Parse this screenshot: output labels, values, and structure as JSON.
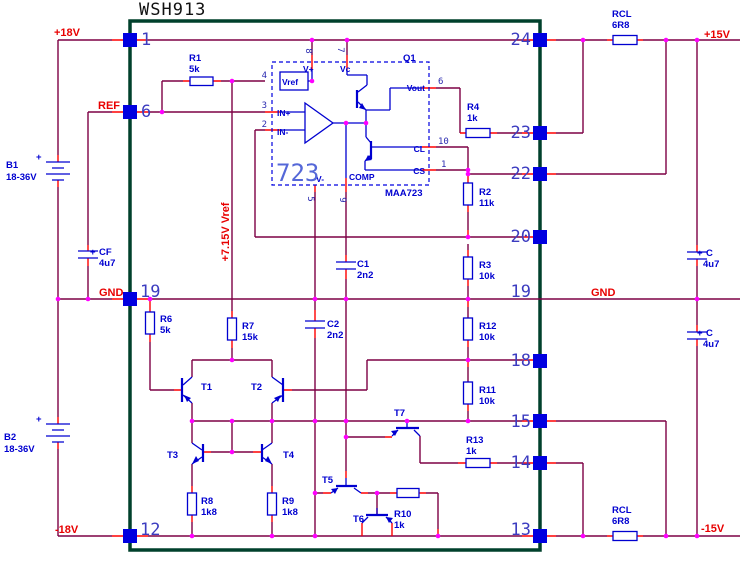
{
  "title": "WSH913",
  "colors": {
    "wire": "#7d0045",
    "stub": "#ff0000",
    "component": "#0000d0",
    "pin_pad": "#0000e0",
    "junction": "#ff00ff",
    "module_border": "#00402c",
    "net_label": "#e80000",
    "pin_number": "#3c3cc0",
    "background": "#ffffff"
  },
  "pins_left": [
    "1",
    "6",
    "19",
    "12"
  ],
  "pins_right": [
    "24",
    "23",
    "22",
    "20",
    "19",
    "18",
    "15",
    "14",
    "13"
  ],
  "nets": {
    "p18v": "+18V",
    "ref": "REF",
    "gnd_left": "GND",
    "m18v": "-18V",
    "p15v": "+15V",
    "gnd_right": "GND",
    "m15v": "-15V",
    "vref_rail": "+7.15V Vref"
  },
  "ic": {
    "q1": "Q1",
    "big": "723",
    "part": "MAA723",
    "vref": "Vref",
    "vplus": "V+",
    "vc": "Vc",
    "inplus": "IN+",
    "inminus": "IN-",
    "vminus": "V-",
    "comp": "COMP",
    "vout": "Vout",
    "cl": "CL",
    "cs": "CS",
    "d8": "8",
    "d7": "7",
    "d4": "4",
    "d3": "3",
    "d2": "2",
    "d6": "6",
    "d10": "10",
    "d1": "1",
    "d5": "5",
    "d9": "9"
  },
  "components": {
    "r1": {
      "name": "R1",
      "value": "5k"
    },
    "r2": {
      "name": "R2",
      "value": "11k"
    },
    "r3": {
      "name": "R3",
      "value": "10k"
    },
    "r4": {
      "name": "R4",
      "value": "1k"
    },
    "r6": {
      "name": "R6",
      "value": "5k"
    },
    "r7": {
      "name": "R7",
      "value": "15k"
    },
    "r8": {
      "name": "R8",
      "value": "1k8"
    },
    "r9": {
      "name": "R9",
      "value": "1k8"
    },
    "r10": {
      "name": "R10",
      "value": "1k"
    },
    "r11": {
      "name": "R11",
      "value": "10k"
    },
    "r12": {
      "name": "R12",
      "value": "10k"
    },
    "r13": {
      "name": "R13",
      "value": "1k"
    },
    "rcl_top": {
      "name": "RCL",
      "value": "6R8"
    },
    "rcl_bottom": {
      "name": "RCL",
      "value": "6R8"
    },
    "c1": {
      "name": "C1",
      "value": "2n2"
    },
    "c2": {
      "name": "C2",
      "value": "2n2"
    },
    "cf": {
      "plus": "+",
      "name": "CF",
      "value": "4u7"
    },
    "c_top": {
      "plus": "+",
      "name": "C",
      "value": "4u7"
    },
    "c_bottom": {
      "plus": "+",
      "name": "C",
      "value": "4u7"
    },
    "b1": {
      "name": "B1",
      "value": "18-36V",
      "plus": "+"
    },
    "b2": {
      "name": "B2",
      "value": "18-36V",
      "plus": "+"
    },
    "t1": {
      "name": "T1"
    },
    "t2": {
      "name": "T2"
    },
    "t3": {
      "name": "T3"
    },
    "t4": {
      "name": "T4"
    },
    "t5": {
      "name": "T5"
    },
    "t6": {
      "name": "T6"
    },
    "t7": {
      "name": "T7"
    }
  }
}
